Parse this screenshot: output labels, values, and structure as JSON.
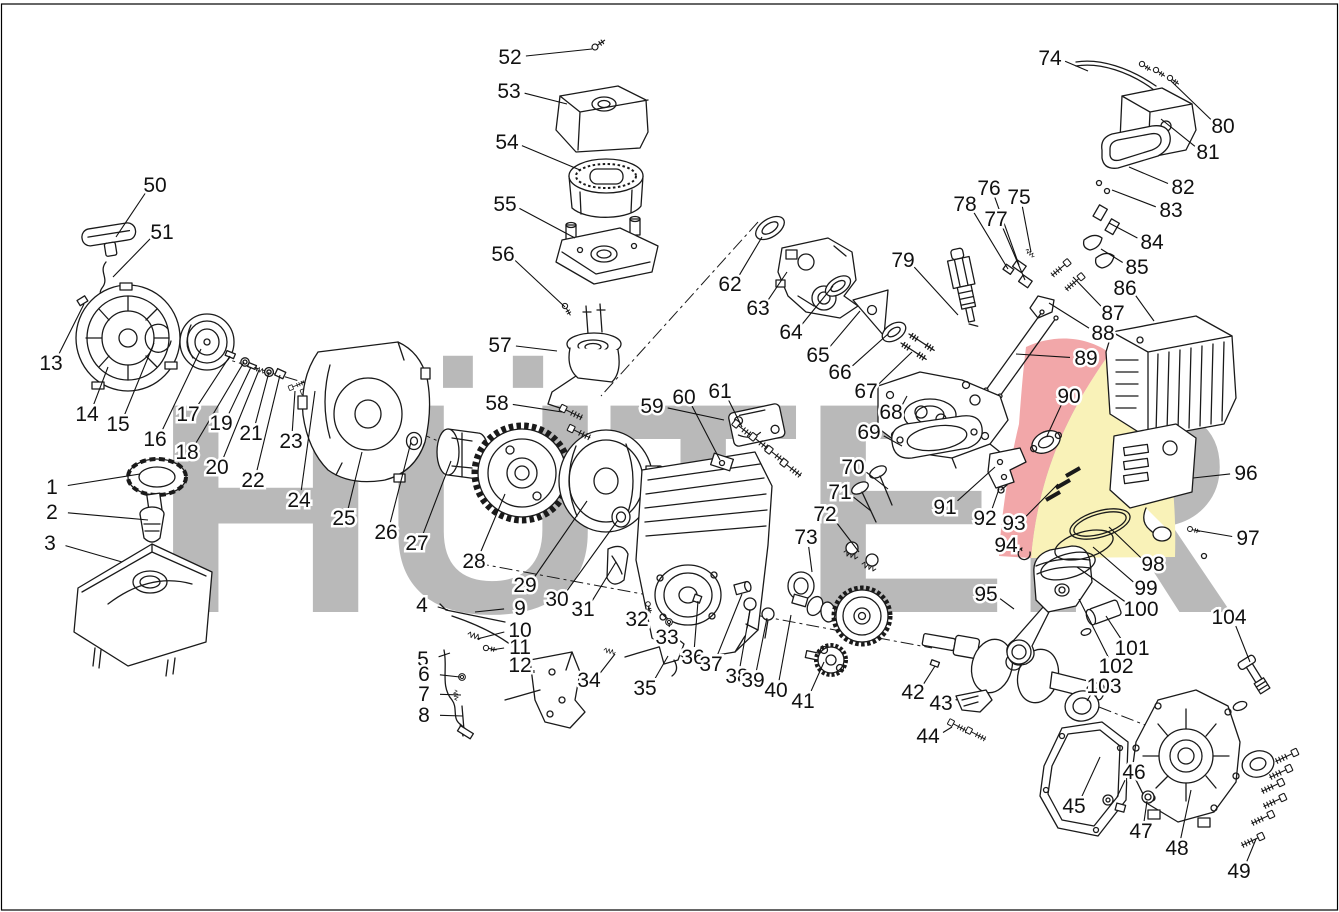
{
  "page": {
    "background": "#ffffff",
    "border_color": "#000000"
  },
  "watermark": {
    "text": "HÜTER",
    "color": "#b9b9b9",
    "swoosh_red": "#f2a7a9",
    "swoosh_yellow": "#f9f2b8"
  },
  "callouts": [
    {
      "n": "1",
      "lx": 52,
      "ly": 487,
      "tx": 140,
      "ty": 474
    },
    {
      "n": "2",
      "lx": 52,
      "ly": 512,
      "tx": 148,
      "ty": 520
    },
    {
      "n": "3",
      "lx": 50,
      "ly": 543,
      "tx": 122,
      "ty": 562
    },
    {
      "n": "4",
      "lx": 422,
      "ly": 605,
      "tx": 448,
      "ty": 610
    },
    {
      "n": "5",
      "lx": 423,
      "ly": 659,
      "tx": 450,
      "ty": 653
    },
    {
      "n": "6",
      "lx": 424,
      "ly": 674,
      "tx": 460,
      "ty": 677
    },
    {
      "n": "7",
      "lx": 424,
      "ly": 694,
      "tx": 461,
      "ty": 695
    },
    {
      "n": "8",
      "lx": 424,
      "ly": 715,
      "tx": 463,
      "ty": 716
    },
    {
      "n": "9",
      "lx": 520,
      "ly": 608,
      "tx": 475,
      "ty": 612
    },
    {
      "n": "10",
      "lx": 520,
      "ly": 630,
      "tx": 477,
      "ty": 639
    },
    {
      "n": "11",
      "lx": 520,
      "ly": 647,
      "tx": 491,
      "ty": 650
    },
    {
      "n": "12",
      "lx": 520,
      "ly": 665,
      "tx": 534,
      "ty": 673
    },
    {
      "n": "13",
      "lx": 51,
      "ly": 363,
      "tx": 84,
      "ty": 304
    },
    {
      "n": "14",
      "lx": 87,
      "ly": 414,
      "tx": 108,
      "ty": 367
    },
    {
      "n": "15",
      "lx": 118,
      "ly": 424,
      "tx": 154,
      "ty": 343
    },
    {
      "n": "16",
      "lx": 155,
      "ly": 439,
      "tx": 201,
      "ty": 349
    },
    {
      "n": "17",
      "lx": 188,
      "ly": 414,
      "tx": 230,
      "ty": 356
    },
    {
      "n": "18",
      "lx": 187,
      "ly": 452,
      "tx": 244,
      "ty": 362
    },
    {
      "n": "19",
      "lx": 221,
      "ly": 423,
      "tx": 251,
      "ty": 367
    },
    {
      "n": "20",
      "lx": 217,
      "ly": 467,
      "tx": 259,
      "ty": 370
    },
    {
      "n": "21",
      "lx": 251,
      "ly": 433,
      "tx": 269,
      "ty": 372
    },
    {
      "n": "22",
      "lx": 253,
      "ly": 480,
      "tx": 280,
      "ty": 375
    },
    {
      "n": "23",
      "lx": 291,
      "ly": 441,
      "tx": 295,
      "ty": 391
    },
    {
      "n": "24",
      "lx": 299,
      "ly": 500,
      "tx": 315,
      "ty": 391
    },
    {
      "n": "25",
      "lx": 344,
      "ly": 518,
      "tx": 362,
      "ty": 452
    },
    {
      "n": "26",
      "lx": 386,
      "ly": 532,
      "tx": 411,
      "ty": 442
    },
    {
      "n": "27",
      "lx": 417,
      "ly": 543,
      "tx": 451,
      "ty": 461
    },
    {
      "n": "28",
      "lx": 474,
      "ly": 561,
      "tx": 505,
      "ty": 494
    },
    {
      "n": "29",
      "lx": 525,
      "ly": 585,
      "tx": 587,
      "ty": 501
    },
    {
      "n": "30",
      "lx": 557,
      "ly": 599,
      "tx": 618,
      "ty": 520
    },
    {
      "n": "31",
      "lx": 583,
      "ly": 609,
      "tx": 616,
      "ty": 562
    },
    {
      "n": "32",
      "lx": 637,
      "ly": 619,
      "tx": 649,
      "ty": 606
    },
    {
      "n": "33",
      "lx": 667,
      "ly": 637,
      "tx": 669,
      "ty": 623
    },
    {
      "n": "34",
      "lx": 589,
      "ly": 680,
      "tx": 615,
      "ty": 654
    },
    {
      "n": "35",
      "lx": 645,
      "ly": 688,
      "tx": 668,
      "ty": 656
    },
    {
      "n": "36",
      "lx": 693,
      "ly": 657,
      "tx": 698,
      "ty": 601
    },
    {
      "n": "37",
      "lx": 711,
      "ly": 664,
      "tx": 742,
      "ty": 594
    },
    {
      "n": "38",
      "lx": 737,
      "ly": 676,
      "tx": 750,
      "ty": 610
    },
    {
      "n": "39",
      "lx": 753,
      "ly": 680,
      "tx": 767,
      "ty": 618
    },
    {
      "n": "40",
      "lx": 776,
      "ly": 690,
      "tx": 791,
      "ty": 615
    },
    {
      "n": "41",
      "lx": 803,
      "ly": 701,
      "tx": 824,
      "ty": 662
    },
    {
      "n": "42",
      "lx": 913,
      "ly": 692,
      "tx": 935,
      "ty": 666
    },
    {
      "n": "43",
      "lx": 941,
      "ly": 703,
      "tx": 956,
      "ty": 699
    },
    {
      "n": "44",
      "lx": 928,
      "ly": 736,
      "tx": 952,
      "ty": 727
    },
    {
      "n": "45",
      "lx": 1074,
      "ly": 806,
      "tx": 1100,
      "ty": 757
    },
    {
      "n": "46",
      "lx": 1134,
      "ly": 772,
      "tx": 1117,
      "ty": 797
    },
    {
      "n": "47",
      "lx": 1141,
      "ly": 831,
      "tx": 1147,
      "ty": 801
    },
    {
      "n": "48",
      "lx": 1177,
      "ly": 848,
      "tx": 1191,
      "ty": 790
    },
    {
      "n": "49",
      "lx": 1239,
      "ly": 871,
      "tx": 1256,
      "ty": 839
    },
    {
      "n": "50",
      "lx": 155,
      "ly": 185,
      "tx": 116,
      "ty": 237
    },
    {
      "n": "51",
      "lx": 162,
      "ly": 232,
      "tx": 113,
      "ty": 277
    },
    {
      "n": "52",
      "lx": 510,
      "ly": 57,
      "tx": 592,
      "ty": 49
    },
    {
      "n": "53",
      "lx": 509,
      "ly": 91,
      "tx": 567,
      "ty": 104
    },
    {
      "n": "54",
      "lx": 507,
      "ly": 142,
      "tx": 580,
      "ty": 170
    },
    {
      "n": "55",
      "lx": 505,
      "ly": 204,
      "tx": 575,
      "ty": 238
    },
    {
      "n": "56",
      "lx": 503,
      "ly": 254,
      "tx": 565,
      "ty": 307
    },
    {
      "n": "57",
      "lx": 500,
      "ly": 345,
      "tx": 557,
      "ty": 351
    },
    {
      "n": "58",
      "lx": 497,
      "ly": 403,
      "tx": 562,
      "ty": 412
    },
    {
      "n": "59",
      "lx": 652,
      "ly": 406,
      "tx": 724,
      "ty": 420
    },
    {
      "n": "60",
      "lx": 684,
      "ly": 397,
      "tx": 720,
      "ty": 460
    },
    {
      "n": "61",
      "lx": 720,
      "ly": 391,
      "tx": 742,
      "ty": 427
    },
    {
      "n": "62",
      "lx": 730,
      "ly": 284,
      "tx": 762,
      "ty": 237
    },
    {
      "n": "63",
      "lx": 758,
      "ly": 308,
      "tx": 787,
      "ty": 272
    },
    {
      "n": "64",
      "lx": 791,
      "ly": 332,
      "tx": 833,
      "ty": 286
    },
    {
      "n": "65",
      "lx": 818,
      "ly": 355,
      "tx": 860,
      "ty": 311
    },
    {
      "n": "66",
      "lx": 840,
      "ly": 372,
      "tx": 888,
      "ty": 334
    },
    {
      "n": "67",
      "lx": 866,
      "ly": 391,
      "tx": 912,
      "ty": 352
    },
    {
      "n": "68",
      "lx": 891,
      "ly": 412,
      "tx": 907,
      "ty": 396
    },
    {
      "n": "69",
      "lx": 869,
      "ly": 432,
      "tx": 902,
      "ty": 446
    },
    {
      "n": "70",
      "lx": 853,
      "ly": 467,
      "tx": 888,
      "ty": 489
    },
    {
      "n": "71",
      "lx": 840,
      "ly": 492,
      "tx": 871,
      "ty": 511
    },
    {
      "n": "72",
      "lx": 825,
      "ly": 514,
      "tx": 859,
      "ty": 552
    },
    {
      "n": "73",
      "lx": 806,
      "ly": 537,
      "tx": 812,
      "ty": 572
    },
    {
      "n": "74",
      "lx": 1050,
      "ly": 58,
      "tx": 1088,
      "ty": 71
    },
    {
      "n": "75",
      "lx": 1019,
      "ly": 197,
      "tx": 1031,
      "ty": 252
    },
    {
      "n": "76",
      "lx": 989,
      "ly": 188,
      "tx": 1019,
      "ty": 265
    },
    {
      "n": "77",
      "lx": 996,
      "ly": 219,
      "tx": 1025,
      "ty": 280
    },
    {
      "n": "78",
      "lx": 965,
      "ly": 204,
      "tx": 1008,
      "ty": 269
    },
    {
      "n": "79",
      "lx": 903,
      "ly": 260,
      "tx": 958,
      "ty": 315
    },
    {
      "n": "80",
      "lx": 1223,
      "ly": 126,
      "tx": 1171,
      "ty": 81
    },
    {
      "n": "81",
      "lx": 1208,
      "ly": 152,
      "tx": 1161,
      "ty": 119
    },
    {
      "n": "82",
      "lx": 1183,
      "ly": 187,
      "tx": 1129,
      "ty": 167
    },
    {
      "n": "83",
      "lx": 1171,
      "ly": 210,
      "tx": 1112,
      "ty": 190
    },
    {
      "n": "84",
      "lx": 1152,
      "ly": 242,
      "tx": 1109,
      "ty": 223
    },
    {
      "n": "85",
      "lx": 1137,
      "ly": 267,
      "tx": 1101,
      "ty": 249
    },
    {
      "n": "86",
      "lx": 1125,
      "ly": 288,
      "tx": 1154,
      "ty": 321
    },
    {
      "n": "87",
      "lx": 1113,
      "ly": 313,
      "tx": 1073,
      "ty": 277
    },
    {
      "n": "88",
      "lx": 1103,
      "ly": 333,
      "tx": 1049,
      "ty": 303
    },
    {
      "n": "89",
      "lx": 1086,
      "ly": 358,
      "tx": 1016,
      "ty": 354
    },
    {
      "n": "90",
      "lx": 1069,
      "ly": 396,
      "tx": 1047,
      "ty": 436
    },
    {
      "n": "91",
      "lx": 945,
      "ly": 507,
      "tx": 995,
      "ty": 467
    },
    {
      "n": "92",
      "lx": 985,
      "ly": 518,
      "tx": 999,
      "ty": 489
    },
    {
      "n": "93",
      "lx": 1014,
      "ly": 523,
      "tx": 1058,
      "ty": 484
    },
    {
      "n": "94",
      "lx": 1006,
      "ly": 545,
      "tx": 1022,
      "ty": 551
    },
    {
      "n": "95",
      "lx": 986,
      "ly": 594,
      "tx": 1014,
      "ty": 609
    },
    {
      "n": "96",
      "lx": 1246,
      "ly": 473,
      "tx": 1193,
      "ty": 478
    },
    {
      "n": "97",
      "lx": 1248,
      "ly": 538,
      "tx": 1194,
      "ty": 530
    },
    {
      "n": "98",
      "lx": 1153,
      "ly": 564,
      "tx": 1109,
      "ty": 527
    },
    {
      "n": "99",
      "lx": 1146,
      "ly": 588,
      "tx": 1093,
      "ty": 547
    },
    {
      "n": "100",
      "lx": 1141,
      "ly": 609,
      "tx": 1077,
      "ty": 567
    },
    {
      "n": "101",
      "lx": 1132,
      "ly": 648,
      "tx": 1106,
      "ty": 616
    },
    {
      "n": "102",
      "lx": 1116,
      "ly": 666,
      "tx": 1079,
      "ty": 599
    },
    {
      "n": "103",
      "lx": 1104,
      "ly": 686,
      "tx": 1087,
      "ty": 701
    },
    {
      "n": "104",
      "lx": 1229,
      "ly": 617,
      "tx": 1250,
      "ty": 662
    }
  ]
}
